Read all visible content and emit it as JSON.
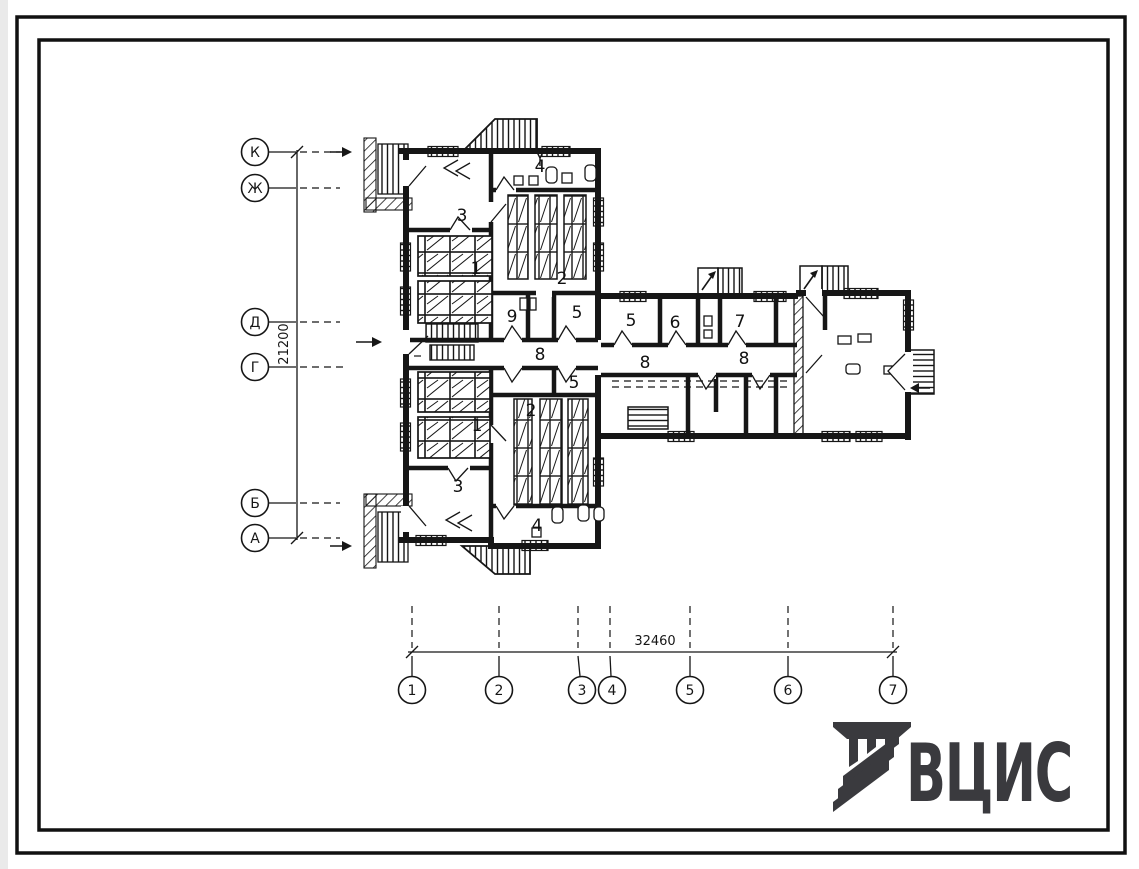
{
  "drawing": {
    "axes_left": {
      "dimension": "21200",
      "labels": [
        "К",
        "Ж",
        "Д",
        "Г",
        "Б",
        "А"
      ]
    },
    "axes_bottom": {
      "dimension": "32460",
      "labels": [
        "1",
        "2",
        "3",
        "4",
        "5",
        "6",
        "7"
      ]
    },
    "rooms": [
      {
        "n": "3"
      },
      {
        "n": "1"
      },
      {
        "n": "2"
      },
      {
        "n": "4"
      },
      {
        "n": "9"
      },
      {
        "n": "5"
      },
      {
        "n": "8"
      },
      {
        "n": "5"
      },
      {
        "n": "2"
      },
      {
        "n": "1"
      },
      {
        "n": "3"
      },
      {
        "n": "4"
      },
      {
        "n": "5"
      },
      {
        "n": "6"
      },
      {
        "n": "7"
      },
      {
        "n": "8"
      },
      {
        "n": "8"
      }
    ],
    "logo": {
      "text": "ВЦИС",
      "icon": "striped-monogram-icon",
      "color": "#3a3a3e"
    }
  }
}
